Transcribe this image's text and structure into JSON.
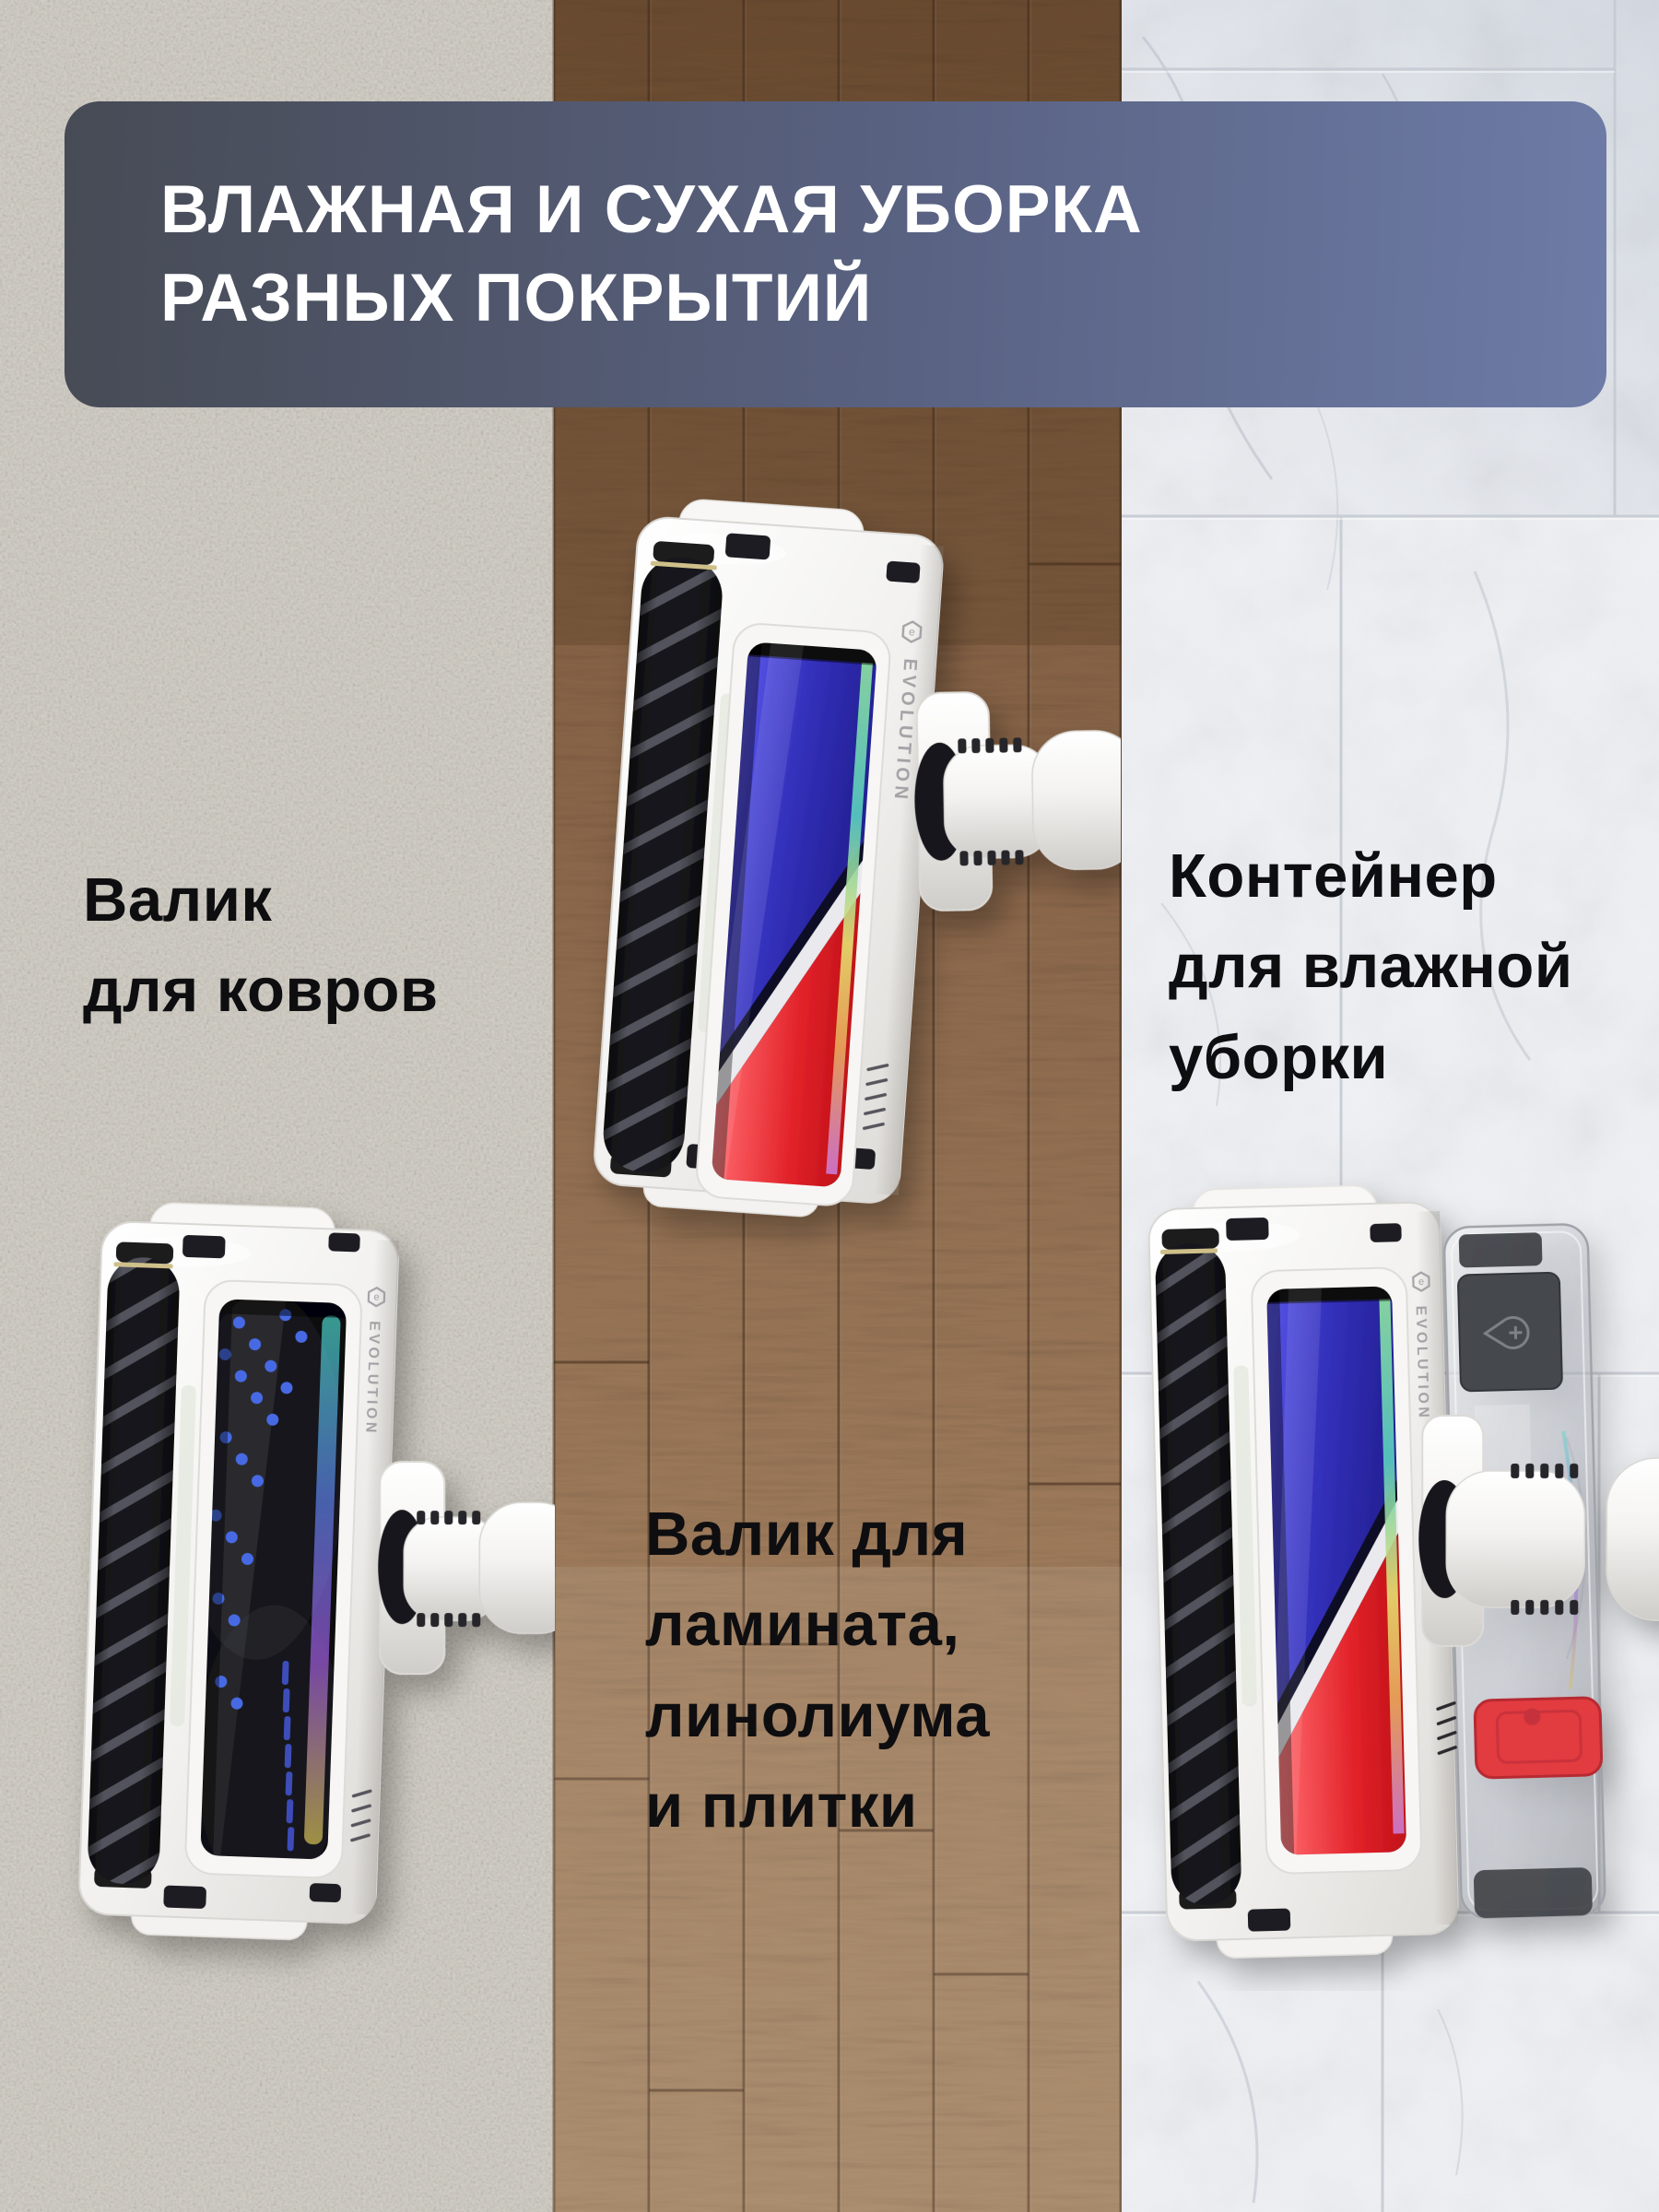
{
  "banner": {
    "line1": "ВЛАЖНАЯ И СУХАЯ УБОРКА",
    "line2": "РАЗНЫХ ПОКРЫТИЙ",
    "background_left": "#474b55",
    "background_right": "#6d7ba6",
    "text_color": "#ffffff",
    "corner_radius_px": 38
  },
  "labels": {
    "text_color": "#0e0e10",
    "carpet_roller": {
      "lines": [
        "Валик",
        "для ковров"
      ]
    },
    "wet_container": {
      "lines": [
        "Контейнер",
        "для влажной",
        "уборки"
      ]
    },
    "hard_floor_roller": {
      "lines": [
        "Валик для",
        "ламината,",
        "линолиума",
        "и плитки"
      ]
    }
  },
  "products": {
    "brand": "EVOLUTION",
    "logo_icon": "hexagon-e-icon",
    "count": 3,
    "colors": {
      "body_white": "#f4f3f1",
      "brush_roller_dark": "#17171b",
      "roller_blue": "#3431bd",
      "roller_red": "#e22229",
      "silver_divider": "#e9e9ee",
      "latch_red": "#e23a3f",
      "tank_cap_gray": "#45484d",
      "carpet_brush_dot_blue": "#466be4"
    }
  },
  "surfaces": {
    "carpet_color": "#d3cfc6",
    "wood_color_top": "#8d6948",
    "wood_color_bottom": "#c6a47e",
    "marble_color": "#eef0f4"
  },
  "icons": {
    "brand_logo": "hexagon-e-icon",
    "tank_cap": "water-drop-plus-icon"
  }
}
